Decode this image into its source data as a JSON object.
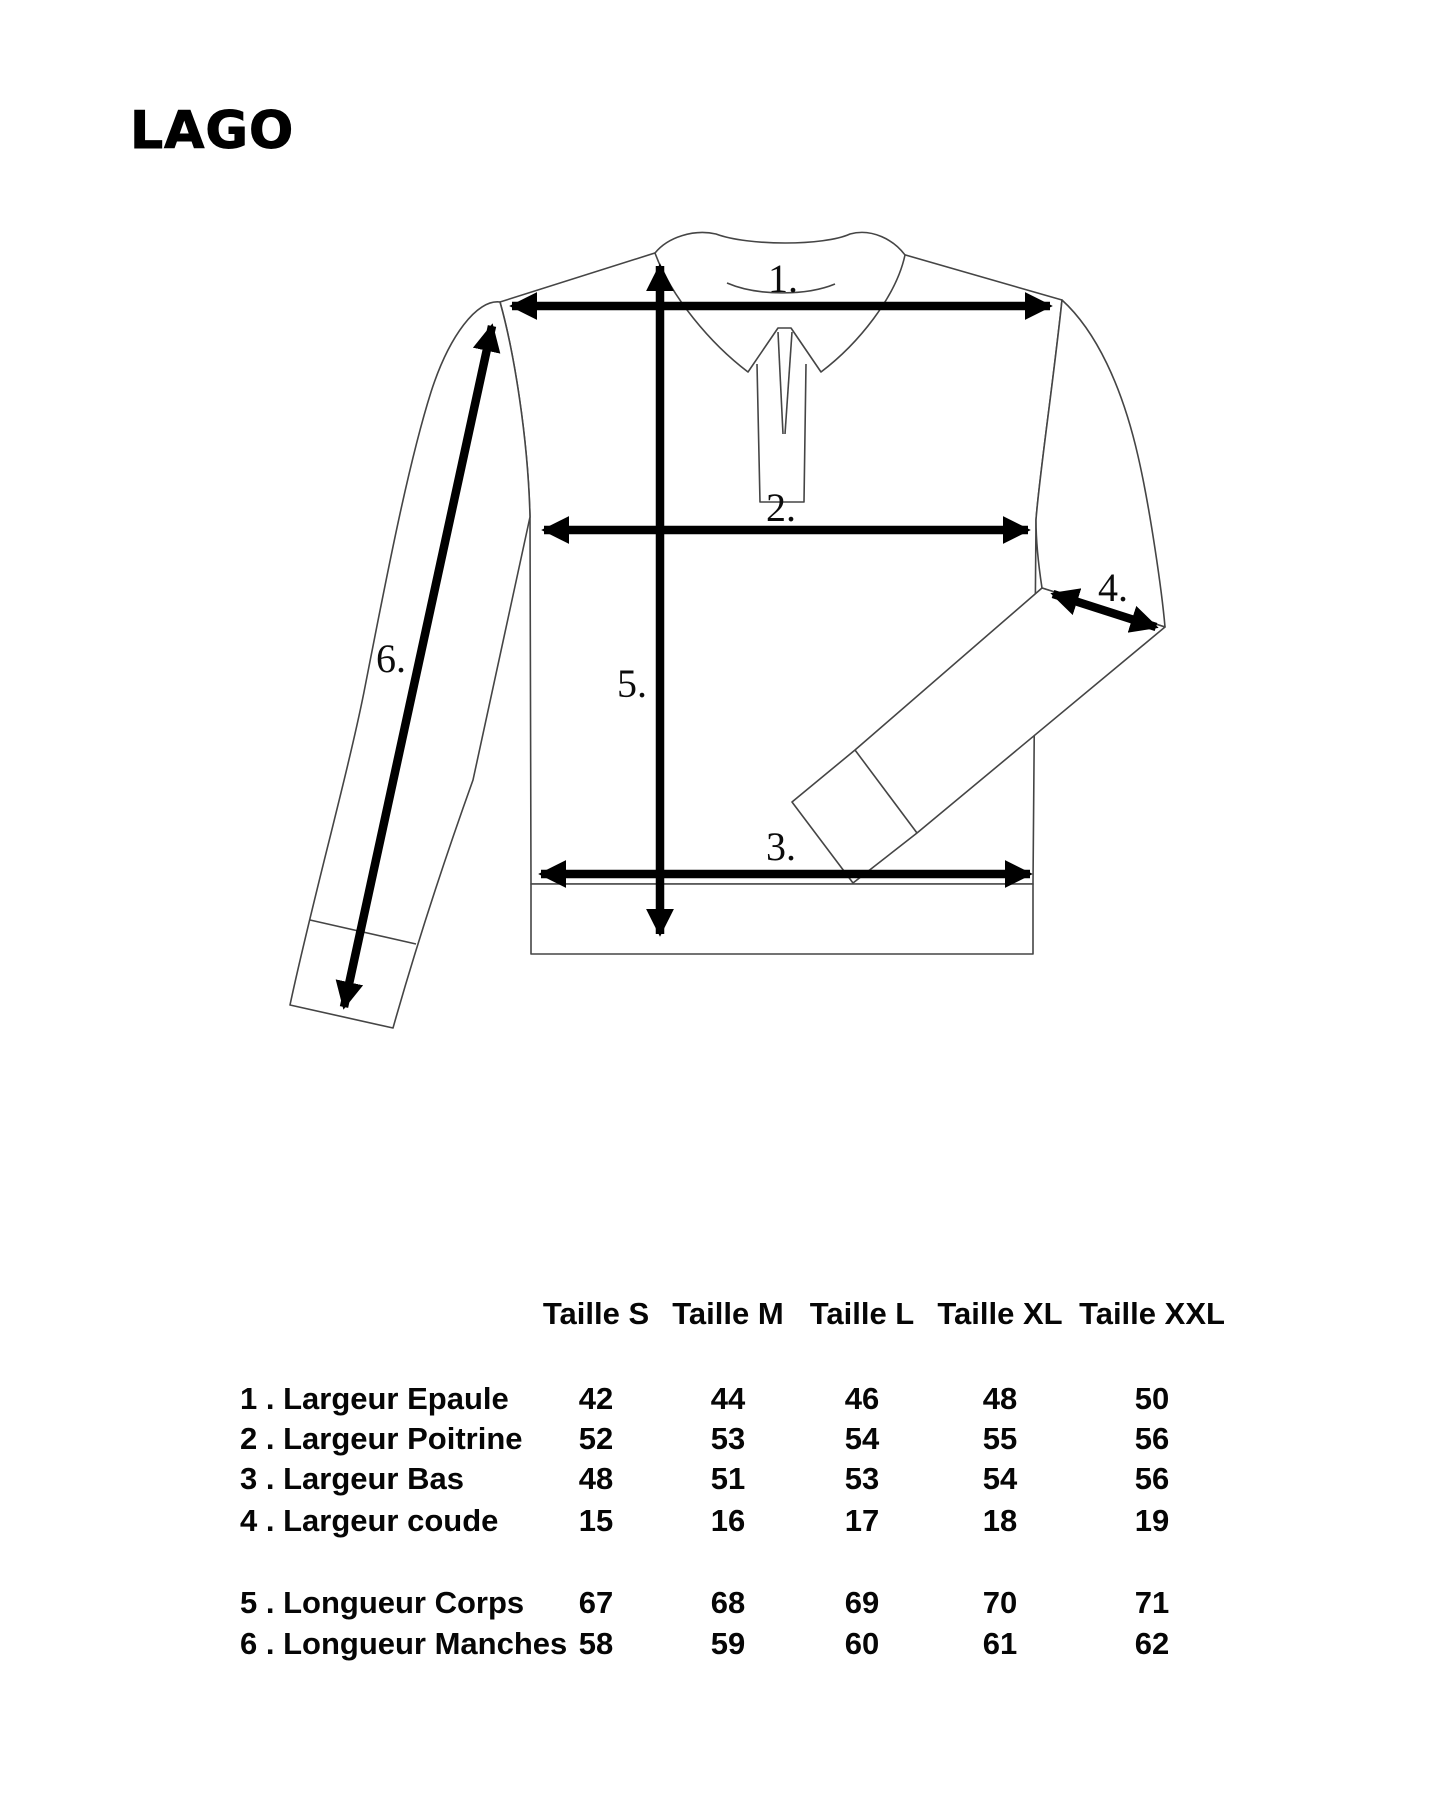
{
  "title": "LAGO",
  "diagram": {
    "description": "technical flat drawing of a long-sleeve polo shirt with numbered measurement arrows",
    "labels": {
      "l1": "1.",
      "l2": "2.",
      "l3": "3.",
      "l4": "4.",
      "l5": "5.",
      "l6": "6."
    }
  },
  "size_table": {
    "columns": [
      "Taille S",
      "Taille M",
      "Taille L",
      "Taille XL",
      "Taille XXL"
    ],
    "rows": [
      {
        "label": "1 . Largeur Epaule",
        "values": [
          "42",
          "44",
          "46",
          "48",
          "50"
        ]
      },
      {
        "label": "2 . Largeur Poitrine",
        "values": [
          "52",
          "53",
          "54",
          "55",
          "56"
        ]
      },
      {
        "label": "3 . Largeur Bas",
        "values": [
          "48",
          "51",
          "53",
          "54",
          "56"
        ]
      },
      {
        "label": "4 . Largeur coude",
        "values": [
          "15",
          "16",
          "17",
          "18",
          "19"
        ]
      },
      {
        "label": "5 . Longueur Corps",
        "values": [
          "67",
          "68",
          "69",
          "70",
          "71"
        ]
      },
      {
        "label": "6 . Longueur Manches",
        "values": [
          "58",
          "59",
          "60",
          "61",
          "62"
        ]
      }
    ]
  },
  "colors": {
    "ink": "#000000",
    "outline": "#454545",
    "background": "#ffffff"
  }
}
